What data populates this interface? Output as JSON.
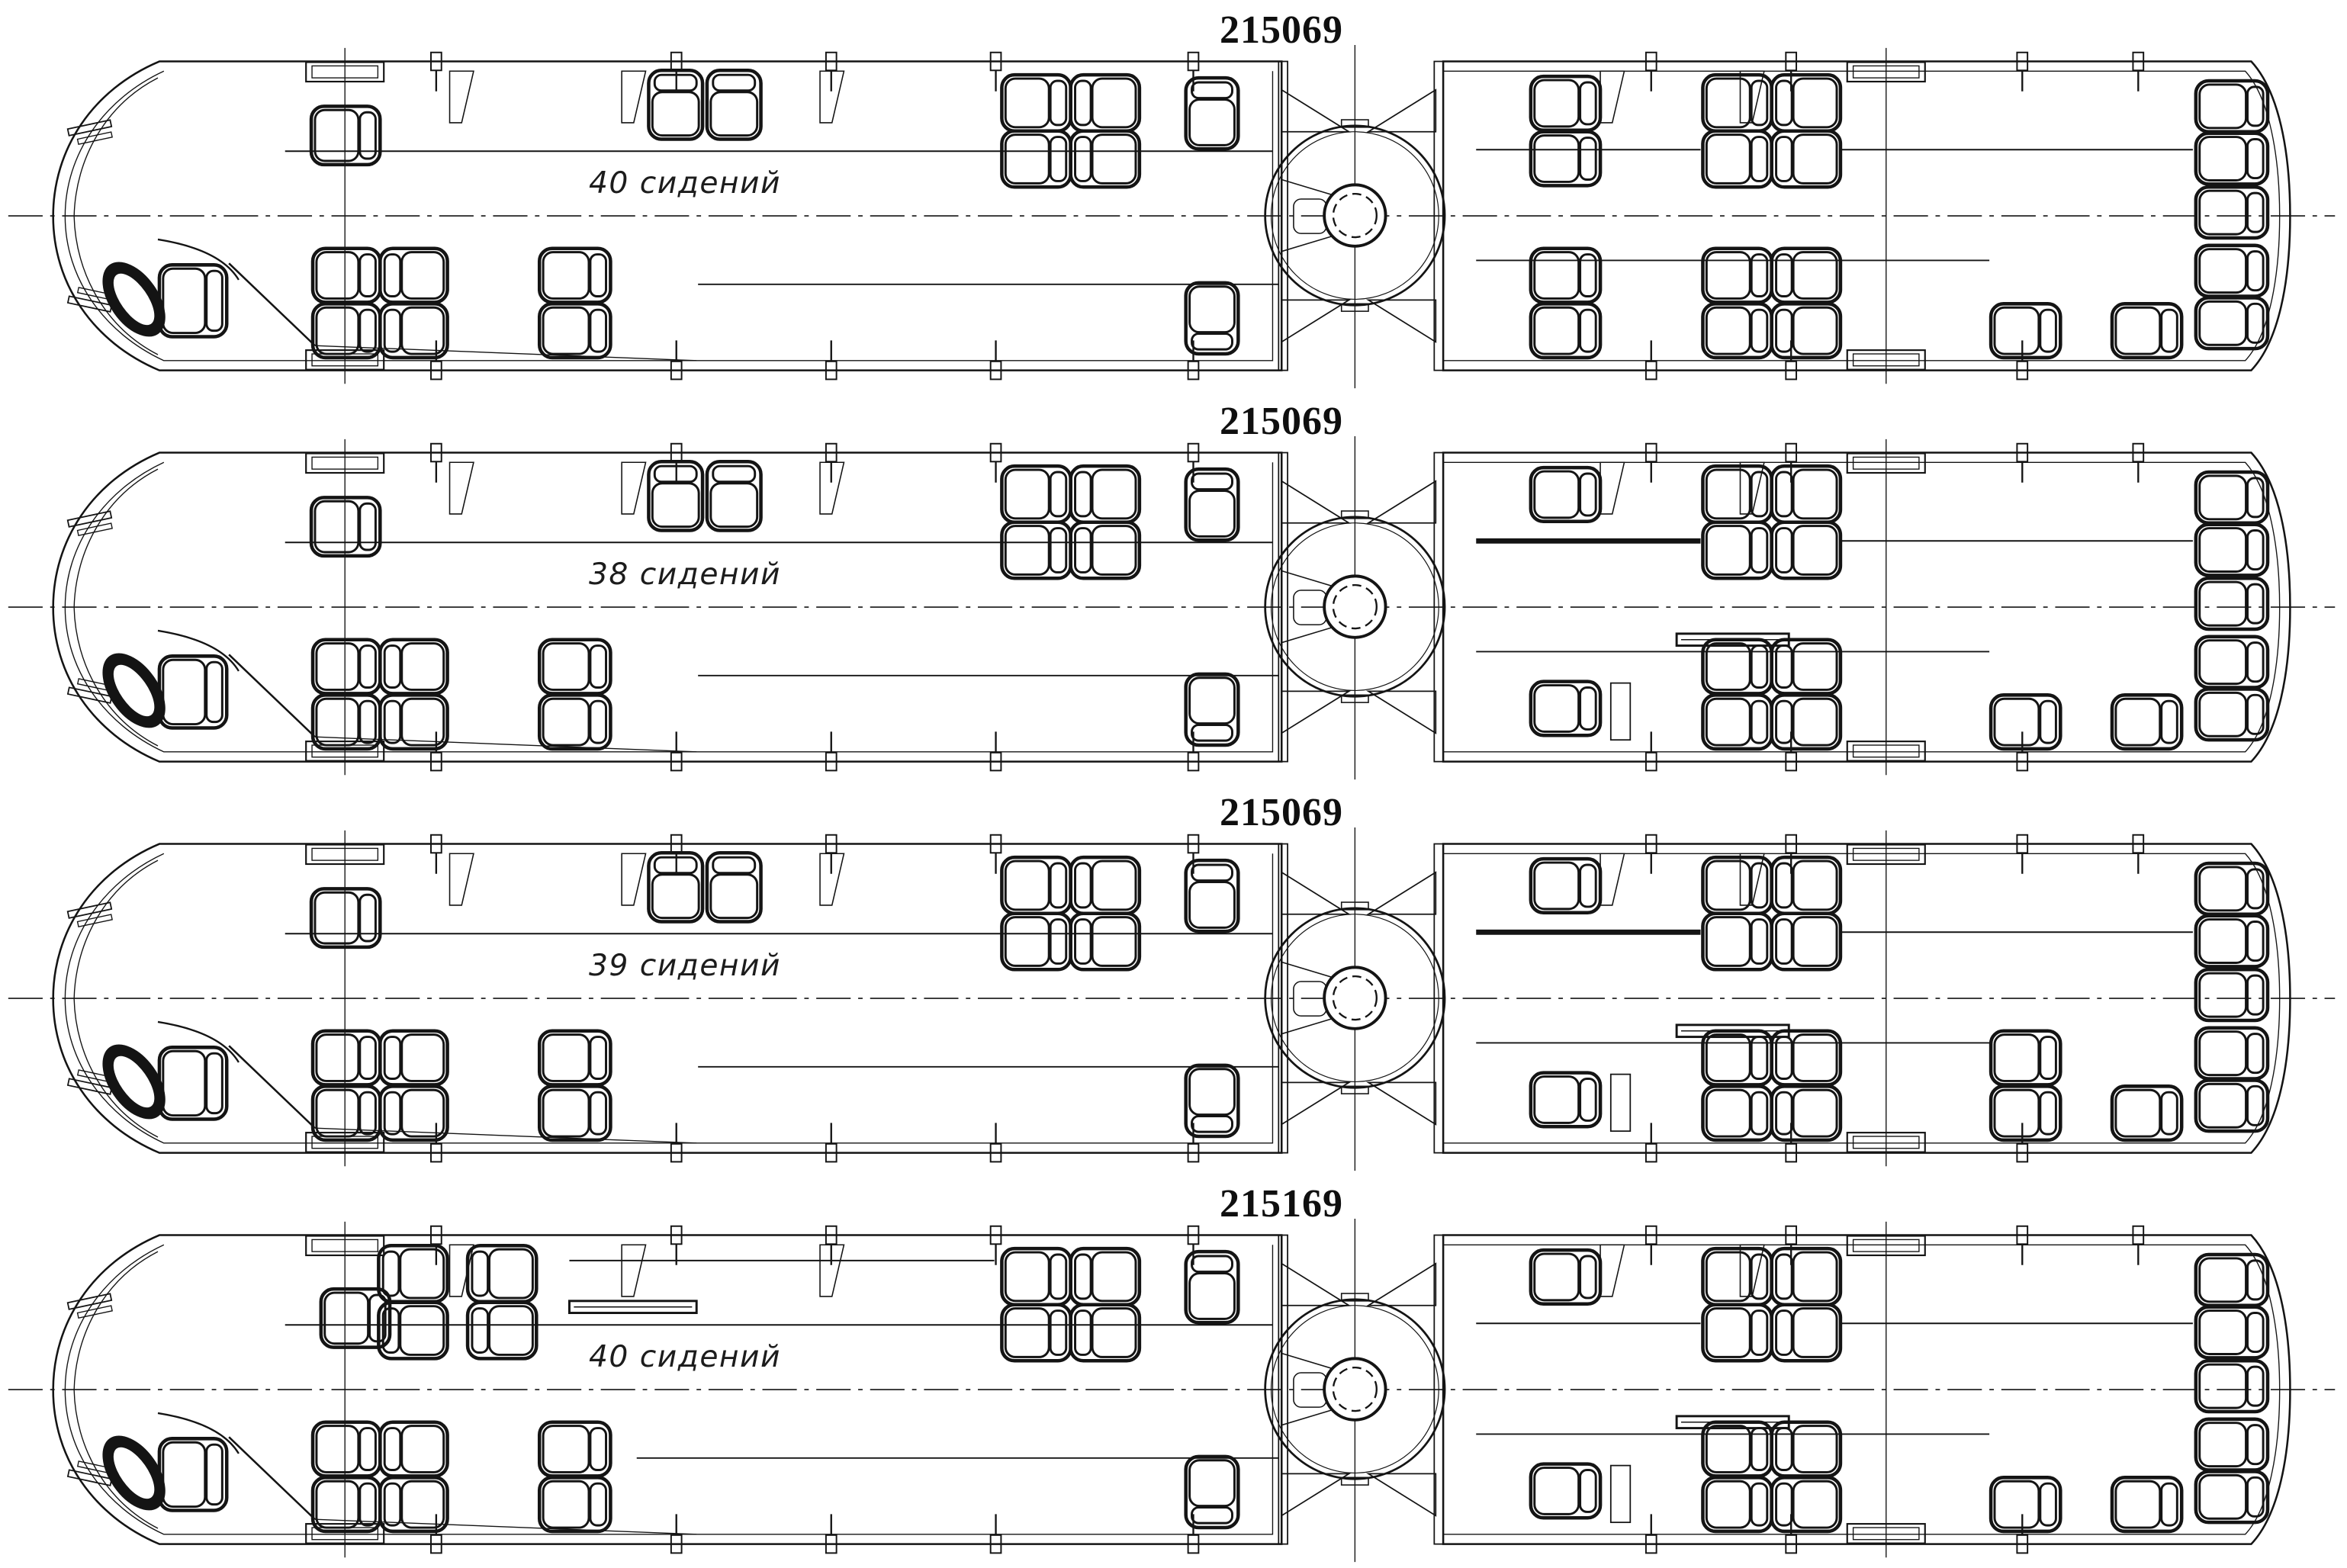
{
  "page": {
    "background": "#ffffff",
    "line_color": "#141414",
    "accent": "#0f0f0f"
  },
  "rows": [
    {
      "title": "215069",
      "seats_label": "40 сидений",
      "variant": "A"
    },
    {
      "title": "215069",
      "seats_label": "38 сидений",
      "variant": "B"
    },
    {
      "title": "215069",
      "seats_label": "39 сидений",
      "variant": "C"
    },
    {
      "title": "215169",
      "seats_label": "40 сидений",
      "variant": "D"
    }
  ],
  "variants": {
    "A": {
      "seats": [
        [
          355,
          60,
          92,
          78,
          "R"
        ],
        [
          806,
          12,
          72,
          92,
          "T"
        ],
        [
          884,
          12,
          72,
          92,
          "T"
        ],
        [
          1278,
          18,
          92,
          75,
          "R"
        ],
        [
          1278,
          93,
          92,
          75,
          "R"
        ],
        [
          1370,
          18,
          92,
          75,
          "L"
        ],
        [
          1370,
          93,
          92,
          75,
          "L"
        ],
        [
          1524,
          22,
          70,
          95,
          "T"
        ],
        [
          357,
          250,
          90,
          72,
          "R"
        ],
        [
          357,
          324,
          90,
          72,
          "R"
        ],
        [
          447,
          250,
          90,
          72,
          "L"
        ],
        [
          447,
          324,
          90,
          72,
          "L"
        ],
        [
          660,
          250,
          95,
          72,
          "R"
        ],
        [
          660,
          324,
          95,
          72,
          "R"
        ],
        [
          1524,
          296,
          70,
          95,
          "B"
        ],
        [
          1985,
          20,
          93,
          72,
          "R"
        ],
        [
          1985,
          94,
          93,
          72,
          "R"
        ],
        [
          2215,
          18,
          92,
          75,
          "R"
        ],
        [
          2215,
          93,
          92,
          75,
          "R"
        ],
        [
          2307,
          18,
          92,
          75,
          "L"
        ],
        [
          2307,
          93,
          92,
          75,
          "L"
        ],
        [
          1985,
          250,
          93,
          72,
          "R"
        ],
        [
          1985,
          324,
          93,
          72,
          "R"
        ],
        [
          2215,
          250,
          92,
          72,
          "R"
        ],
        [
          2215,
          324,
          92,
          72,
          "R"
        ],
        [
          2307,
          250,
          92,
          72,
          "L"
        ],
        [
          2307,
          324,
          92,
          72,
          "L"
        ],
        [
          2600,
          324,
          93,
          72,
          "R"
        ],
        [
          2762,
          324,
          93,
          72,
          "R"
        ],
        [
          2874,
          26,
          96,
          68,
          "R"
        ],
        [
          2874,
          96,
          96,
          68,
          "R"
        ],
        [
          2874,
          168,
          96,
          68,
          "R"
        ],
        [
          2874,
          246,
          96,
          68,
          "R"
        ],
        [
          2874,
          316,
          96,
          68,
          "R"
        ]
      ],
      "rails": [
        [
          320,
          120,
          1640,
          120,
          2
        ],
        [
          872,
          298,
          1648,
          298,
          2
        ],
        [
          1912,
          118,
          2212,
          118,
          2
        ],
        [
          2400,
          118,
          2870,
          118,
          2
        ],
        [
          1912,
          266,
          2598,
          266,
          2
        ]
      ],
      "panels": [],
      "bars": []
    },
    "B": {
      "seats": [
        [
          355,
          60,
          92,
          78,
          "R"
        ],
        [
          806,
          12,
          72,
          92,
          "T"
        ],
        [
          884,
          12,
          72,
          92,
          "T"
        ],
        [
          1278,
          18,
          92,
          75,
          "R"
        ],
        [
          1278,
          93,
          92,
          75,
          "R"
        ],
        [
          1370,
          18,
          92,
          75,
          "L"
        ],
        [
          1370,
          93,
          92,
          75,
          "L"
        ],
        [
          1524,
          22,
          70,
          95,
          "T"
        ],
        [
          357,
          250,
          90,
          72,
          "R"
        ],
        [
          357,
          324,
          90,
          72,
          "R"
        ],
        [
          447,
          250,
          90,
          72,
          "L"
        ],
        [
          447,
          324,
          90,
          72,
          "L"
        ],
        [
          660,
          250,
          95,
          72,
          "R"
        ],
        [
          660,
          324,
          95,
          72,
          "R"
        ],
        [
          1524,
          296,
          70,
          95,
          "B"
        ],
        [
          1985,
          20,
          93,
          72,
          "R"
        ],
        [
          2215,
          18,
          92,
          75,
          "R"
        ],
        [
          2215,
          93,
          92,
          75,
          "R"
        ],
        [
          2307,
          18,
          92,
          75,
          "L"
        ],
        [
          2307,
          93,
          92,
          75,
          "L"
        ],
        [
          1985,
          306,
          93,
          72,
          "R"
        ],
        [
          2215,
          250,
          92,
          72,
          "R"
        ],
        [
          2215,
          324,
          92,
          72,
          "R"
        ],
        [
          2307,
          250,
          92,
          72,
          "L"
        ],
        [
          2307,
          324,
          92,
          72,
          "L"
        ],
        [
          2600,
          324,
          93,
          72,
          "R"
        ],
        [
          2762,
          324,
          93,
          72,
          "R"
        ],
        [
          2874,
          26,
          96,
          68,
          "R"
        ],
        [
          2874,
          96,
          96,
          68,
          "R"
        ],
        [
          2874,
          168,
          96,
          68,
          "R"
        ],
        [
          2874,
          246,
          96,
          68,
          "R"
        ],
        [
          2874,
          316,
          96,
          68,
          "R"
        ]
      ],
      "rails": [
        [
          320,
          120,
          1640,
          120,
          2
        ],
        [
          872,
          298,
          1648,
          298,
          2
        ],
        [
          1912,
          118,
          2212,
          118,
          7
        ],
        [
          2400,
          118,
          2870,
          118,
          2
        ],
        [
          1912,
          266,
          2598,
          266,
          2
        ]
      ],
      "panels": [
        [
          2092,
          308,
          26,
          76
        ]
      ],
      "bars": [
        [
          2180,
          242,
          150,
          16
        ]
      ]
    },
    "C": {
      "seats": [
        [
          355,
          60,
          92,
          78,
          "R"
        ],
        [
          806,
          12,
          72,
          92,
          "T"
        ],
        [
          884,
          12,
          72,
          92,
          "T"
        ],
        [
          1278,
          18,
          92,
          75,
          "R"
        ],
        [
          1278,
          93,
          92,
          75,
          "R"
        ],
        [
          1370,
          18,
          92,
          75,
          "L"
        ],
        [
          1370,
          93,
          92,
          75,
          "L"
        ],
        [
          1524,
          22,
          70,
          95,
          "T"
        ],
        [
          357,
          250,
          90,
          72,
          "R"
        ],
        [
          357,
          324,
          90,
          72,
          "R"
        ],
        [
          447,
          250,
          90,
          72,
          "L"
        ],
        [
          447,
          324,
          90,
          72,
          "L"
        ],
        [
          660,
          250,
          95,
          72,
          "R"
        ],
        [
          660,
          324,
          95,
          72,
          "R"
        ],
        [
          1524,
          296,
          70,
          95,
          "B"
        ],
        [
          1985,
          20,
          93,
          72,
          "R"
        ],
        [
          2215,
          18,
          92,
          75,
          "R"
        ],
        [
          2215,
          93,
          92,
          75,
          "R"
        ],
        [
          2307,
          18,
          92,
          75,
          "L"
        ],
        [
          2307,
          93,
          92,
          75,
          "L"
        ],
        [
          1985,
          306,
          93,
          72,
          "R"
        ],
        [
          2215,
          250,
          92,
          72,
          "R"
        ],
        [
          2215,
          324,
          92,
          72,
          "R"
        ],
        [
          2307,
          250,
          92,
          72,
          "L"
        ],
        [
          2307,
          324,
          92,
          72,
          "L"
        ],
        [
          2600,
          250,
          93,
          72,
          "R"
        ],
        [
          2600,
          324,
          93,
          72,
          "R"
        ],
        [
          2762,
          324,
          93,
          72,
          "R"
        ],
        [
          2874,
          26,
          96,
          68,
          "R"
        ],
        [
          2874,
          96,
          96,
          68,
          "R"
        ],
        [
          2874,
          168,
          96,
          68,
          "R"
        ],
        [
          2874,
          246,
          96,
          68,
          "R"
        ],
        [
          2874,
          316,
          96,
          68,
          "R"
        ]
      ],
      "rails": [
        [
          320,
          120,
          1640,
          120,
          2
        ],
        [
          872,
          298,
          1648,
          298,
          2
        ],
        [
          1912,
          118,
          2212,
          118,
          7
        ],
        [
          2400,
          118,
          2870,
          118,
          2
        ],
        [
          1912,
          266,
          2598,
          266,
          2
        ]
      ],
      "panels": [
        [
          2092,
          308,
          26,
          76
        ]
      ],
      "bars": [
        [
          2180,
          242,
          150,
          16
        ]
      ]
    },
    "D": {
      "seats": [
        [
          368,
          72,
          92,
          78,
          "R"
        ],
        [
          445,
          14,
          92,
          75,
          "L"
        ],
        [
          445,
          90,
          92,
          75,
          "L"
        ],
        [
          564,
          14,
          92,
          75,
          "L"
        ],
        [
          564,
          90,
          92,
          75,
          "L"
        ],
        [
          1278,
          18,
          92,
          75,
          "R"
        ],
        [
          1278,
          93,
          92,
          75,
          "R"
        ],
        [
          1370,
          18,
          92,
          75,
          "L"
        ],
        [
          1370,
          93,
          92,
          75,
          "L"
        ],
        [
          1524,
          22,
          70,
          95,
          "T"
        ],
        [
          357,
          250,
          90,
          72,
          "R"
        ],
        [
          357,
          324,
          90,
          72,
          "R"
        ],
        [
          447,
          250,
          90,
          72,
          "L"
        ],
        [
          447,
          324,
          90,
          72,
          "L"
        ],
        [
          660,
          250,
          95,
          72,
          "R"
        ],
        [
          660,
          324,
          95,
          72,
          "R"
        ],
        [
          1524,
          296,
          70,
          95,
          "B"
        ],
        [
          1985,
          20,
          93,
          72,
          "R"
        ],
        [
          2215,
          18,
          92,
          75,
          "R"
        ],
        [
          2215,
          93,
          92,
          75,
          "R"
        ],
        [
          2307,
          18,
          92,
          75,
          "L"
        ],
        [
          2307,
          93,
          92,
          75,
          "L"
        ],
        [
          1985,
          306,
          93,
          72,
          "R"
        ],
        [
          2215,
          250,
          92,
          72,
          "R"
        ],
        [
          2215,
          324,
          92,
          72,
          "R"
        ],
        [
          2307,
          250,
          92,
          72,
          "L"
        ],
        [
          2307,
          324,
          92,
          72,
          "L"
        ],
        [
          2600,
          324,
          93,
          72,
          "R"
        ],
        [
          2762,
          324,
          93,
          72,
          "R"
        ],
        [
          2874,
          26,
          96,
          68,
          "R"
        ],
        [
          2874,
          96,
          96,
          68,
          "R"
        ],
        [
          2874,
          168,
          96,
          68,
          "R"
        ],
        [
          2874,
          246,
          96,
          68,
          "R"
        ],
        [
          2874,
          316,
          96,
          68,
          "R"
        ]
      ],
      "rails": [
        [
          320,
          120,
          1640,
          120,
          2
        ],
        [
          790,
          298,
          1648,
          298,
          2
        ],
        [
          700,
          34,
          1268,
          34,
          2
        ],
        [
          1912,
          118,
          2212,
          118,
          2
        ],
        [
          2400,
          118,
          2870,
          118,
          2
        ],
        [
          1912,
          266,
          2598,
          266,
          2
        ]
      ],
      "panels": [
        [
          2092,
          308,
          26,
          76
        ]
      ],
      "bars": [
        [
          2180,
          242,
          150,
          16
        ],
        [
          700,
          88,
          170,
          16
        ]
      ]
    }
  }
}
